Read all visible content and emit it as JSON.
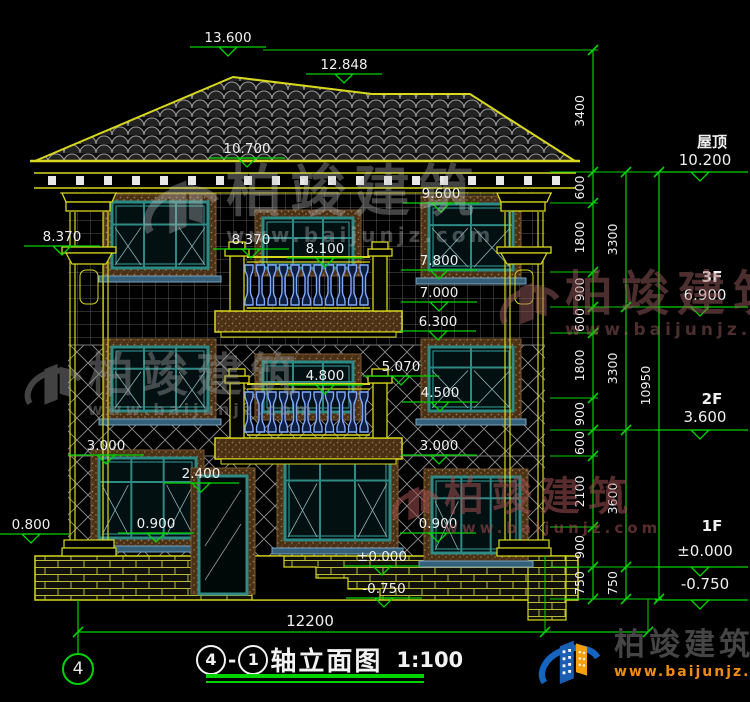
{
  "title": {
    "axis_a": "4",
    "dash": "-",
    "axis_b": "1",
    "name": "轴立面图",
    "scale": "1:100"
  },
  "axis_bubble": "4",
  "brand": {
    "name": "柏竣建筑",
    "url": "www.baijunjz.com"
  },
  "colors": {
    "green": "#00d400",
    "yellow": "#d8d81e",
    "white": "#f0f0f0",
    "teal": "#2e8a84",
    "teal_light": "#8fb5b2",
    "blue": "#7fa8ff",
    "brown": "#7a5a30",
    "sill": "#35607a",
    "grid": "#787878",
    "tile": "#9a9a9a",
    "mortar": "#b9b93a"
  },
  "spot_elevations": [
    {
      "v": "13.600",
      "cx": 228,
      "ty": 30
    },
    {
      "v": "12.848",
      "cx": 344,
      "ty": 57
    },
    {
      "v": "10.700",
      "cx": 247,
      "ty": 141
    },
    {
      "v": "9.600",
      "cx": 441,
      "ty": 186
    },
    {
      "v": "8.370",
      "cx": 62,
      "ty": 229
    },
    {
      "v": "8.370",
      "cx": 251,
      "ty": 232
    },
    {
      "v": "8.100",
      "cx": 325,
      "ty": 241
    },
    {
      "v": "7.800",
      "cx": 439,
      "ty": 253
    },
    {
      "v": "7.000",
      "cx": 439,
      "ty": 285
    },
    {
      "v": "6.300",
      "cx": 438,
      "ty": 314
    },
    {
      "v": "5.070",
      "cx": 401,
      "ty": 359
    },
    {
      "v": "4.800",
      "cx": 325,
      "ty": 368
    },
    {
      "v": "4.500",
      "cx": 440,
      "ty": 385
    },
    {
      "v": "3.000",
      "cx": 106,
      "ty": 438
    },
    {
      "v": "3.000",
      "cx": 439,
      "ty": 438
    },
    {
      "v": "2.400",
      "cx": 201,
      "ty": 466
    },
    {
      "v": "0.900",
      "cx": 156,
      "ty": 516
    },
    {
      "v": "0.800",
      "cx": 31,
      "ty": 517
    },
    {
      "v": "0.900",
      "cx": 438,
      "ty": 516
    },
    {
      "v": "±0.000",
      "cx": 382,
      "ty": 549
    },
    {
      "v": "-0.750",
      "cx": 384,
      "ty": 581
    }
  ],
  "levels_right": [
    {
      "label": "屋顶",
      "value": "10.200",
      "lx": 712,
      "lly": 147,
      "vy": 165,
      "line_y": 172
    },
    {
      "label": "3F",
      "value": "6.900",
      "lx": 712,
      "lly": 282,
      "vy": 300,
      "line_y": 307
    },
    {
      "label": "2F",
      "value": "3.600",
      "lx": 712,
      "lly": 404,
      "vy": 422,
      "line_y": 430
    },
    {
      "label": "1F",
      "value": "±0.000",
      "lx": 712,
      "lly": 531,
      "vy": 556,
      "line_y": 567
    },
    {
      "label": "",
      "value": "-0.750",
      "lx": 712,
      "lly": 0,
      "vy": 589,
      "line_y": 600
    }
  ],
  "dim_chains": [
    {
      "x": 593,
      "boundaries": [
        50,
        172,
        203,
        272,
        307,
        333,
        398,
        430,
        456,
        527,
        567,
        599
      ],
      "labels": [
        "3400",
        "600",
        "1800",
        "900",
        "600",
        "1800",
        "900",
        "600",
        "2100",
        "900",
        "750"
      ]
    },
    {
      "x": 626,
      "boundaries": [
        172,
        307,
        430,
        567,
        599
      ],
      "labels": [
        "3300",
        "3300",
        "3600",
        "750"
      ]
    },
    {
      "x": 659,
      "boundaries": [
        172,
        599
      ],
      "labels": [
        "10950"
      ]
    }
  ],
  "extension_lines": [
    {
      "y": 50,
      "x1": 263,
      "x2": 598
    },
    {
      "y": 172,
      "x1": 550,
      "x2": 662
    },
    {
      "y": 203,
      "x1": 550,
      "x2": 598
    },
    {
      "y": 272,
      "x1": 550,
      "x2": 598
    },
    {
      "y": 307,
      "x1": 550,
      "x2": 662
    },
    {
      "y": 333,
      "x1": 550,
      "x2": 598
    },
    {
      "y": 398,
      "x1": 550,
      "x2": 598
    },
    {
      "y": 430,
      "x1": 550,
      "x2": 662
    },
    {
      "y": 456,
      "x1": 550,
      "x2": 598
    },
    {
      "y": 527,
      "x1": 550,
      "x2": 598
    },
    {
      "y": 567,
      "x1": 550,
      "x2": 662
    },
    {
      "y": 599,
      "x1": 550,
      "x2": 662
    }
  ],
  "bottom_dim": {
    "label": "12200",
    "y": 632,
    "x1": 78,
    "x2": 648,
    "ticks": [
      78,
      545,
      648
    ],
    "lx": 310,
    "ly": 626
  },
  "windows": [
    {
      "x": 112,
      "y": 202,
      "w": 96,
      "h": 66,
      "cols": 3,
      "transom": 0.34,
      "diag": [
        0,
        2
      ],
      "sill": true
    },
    {
      "x": 263,
      "y": 218,
      "w": 90,
      "h": 50,
      "cols": 3,
      "transom": 0.4,
      "diag": [],
      "sill": false
    },
    {
      "x": 429,
      "y": 204,
      "w": 84,
      "h": 66,
      "cols": 2,
      "transom": 0.32,
      "diag": [
        0,
        1
      ],
      "sill": true
    },
    {
      "x": 112,
      "y": 347,
      "w": 96,
      "h": 64,
      "cols": 3,
      "transom": 0.34,
      "diag": [
        0,
        2
      ],
      "sill": true
    },
    {
      "x": 263,
      "y": 362,
      "w": 90,
      "h": 50,
      "cols": 3,
      "transom": 0.4,
      "diag": [],
      "sill": false
    },
    {
      "x": 429,
      "y": 347,
      "w": 84,
      "h": 64,
      "cols": 2,
      "transom": 0.32,
      "diag": [
        0,
        1
      ],
      "sill": true
    },
    {
      "x": 99,
      "y": 458,
      "w": 97,
      "h": 80,
      "cols": 3,
      "transom": 0.3,
      "diag": [
        0,
        2
      ],
      "sill": true
    },
    {
      "x": 285,
      "y": 455,
      "w": 105,
      "h": 85,
      "cols": 3,
      "transom": 0.3,
      "diag": [
        0,
        2
      ],
      "sill": true
    },
    {
      "x": 432,
      "y": 477,
      "w": 88,
      "h": 76,
      "cols": 3,
      "transom": 0.28,
      "diag": [
        0
      ],
      "sill": true
    }
  ],
  "door": {
    "x": 199,
    "y": 476,
    "w": 48,
    "h": 118
  },
  "balconies": [
    {
      "x": 227,
      "w": 163,
      "capY": 242,
      "railY": 257,
      "balTop": 264,
      "balBot": 306,
      "slabY": 311,
      "slabH": 21
    },
    {
      "x": 227,
      "w": 163,
      "capY": 369,
      "railY": 384,
      "balTop": 391,
      "balBot": 433,
      "slabY": 438,
      "slabH": 21
    }
  ],
  "columns": [
    {
      "x": 68
    },
    {
      "x": 503
    }
  ],
  "watermarks": [
    {
      "x": 140,
      "y": 165,
      "glyph": 86,
      "name_size": 56,
      "url_size": 20,
      "color": "#c4c4c4",
      "opacity": 0.34
    },
    {
      "x": 497,
      "y": 270,
      "glyph": 68,
      "name_size": 48,
      "url_size": 17,
      "color": "#a06060",
      "opacity": 0.48
    },
    {
      "x": 22,
      "y": 352,
      "glyph": 66,
      "name_size": 46,
      "url_size": 16,
      "color": "#969696",
      "opacity": 0.44
    },
    {
      "x": 390,
      "y": 477,
      "glyph": 54,
      "name_size": 40,
      "url_size": 15,
      "color": "#a05050",
      "opacity": 0.55
    }
  ]
}
